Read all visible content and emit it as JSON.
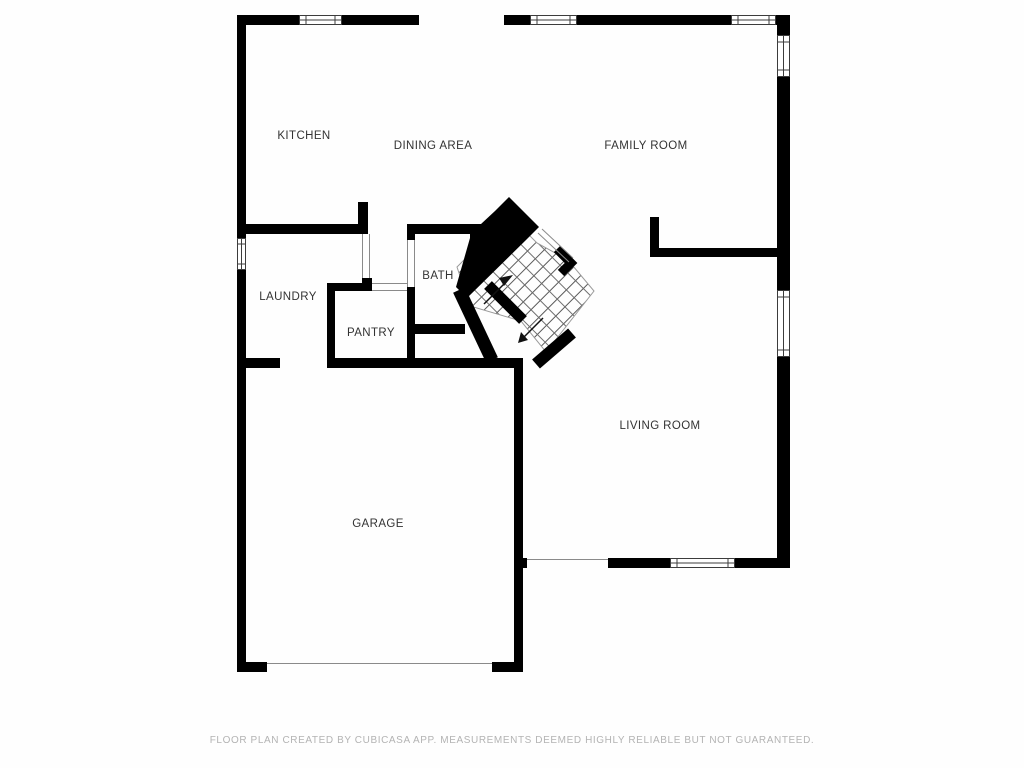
{
  "floor_plan": {
    "rooms": {
      "kitchen": {
        "label": "KITCHEN"
      },
      "dining": {
        "label": "DINING AREA"
      },
      "family": {
        "label": "FAMILY ROOM"
      },
      "laundry": {
        "label": "LAUNDRY"
      },
      "bath": {
        "label": "BATH"
      },
      "pantry": {
        "label": "PANTRY"
      },
      "living": {
        "label": "LIVING ROOM"
      },
      "garage": {
        "label": "GARAGE"
      }
    },
    "footer": "FLOOR PLAN CREATED BY CUBICASA APP. MEASUREMENTS DEEMED HIGHLY RELIABLE BUT NOT GUARANTEED.",
    "colors": {
      "wall": "#000000",
      "bg": "#fefefe",
      "label": "#333333",
      "footer": "#b3b3b3",
      "tread": "#666666",
      "jamb": "#8a8a8a"
    }
  }
}
